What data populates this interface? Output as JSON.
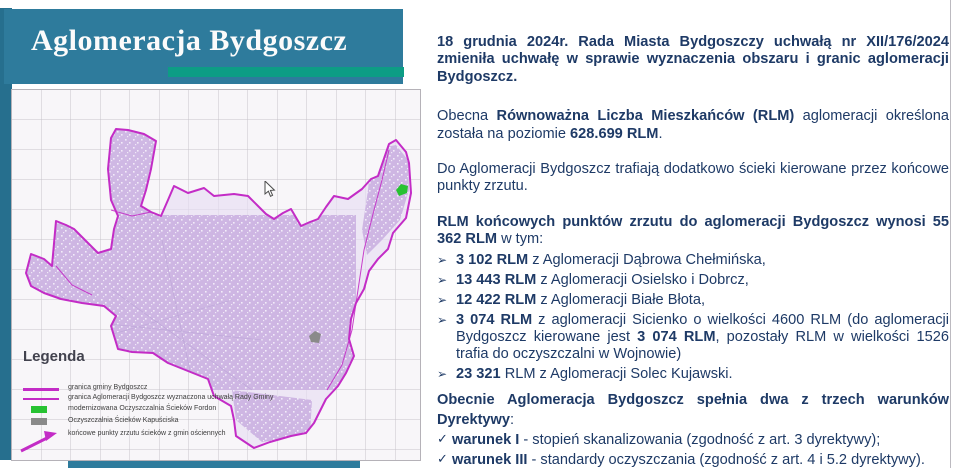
{
  "banner": {
    "title": "Aglomeracja Bydgoszcz"
  },
  "map": {
    "legend": {
      "title": "Legenda",
      "items": [
        {
          "label": "granica gminy Bydgoszcz"
        },
        {
          "label": "granica Aglomeracji Bydgoszcz wyznaczona uchwałą Rady Gminy"
        },
        {
          "label": "modernizowana Oczyszczalnia Ścieków Fordon"
        },
        {
          "label": "Oczyszczalnia Ścieków Kapuściska"
        },
        {
          "label": "końcowe punkty zrzutu ścieków z gmin ościennych"
        }
      ]
    }
  },
  "content": {
    "p1": {
      "segments": [
        {
          "t": "18 grudnia 2024r. Rada Miasta Bydgoszczy uchwałą nr XII/176/2024 zmieniła uchwałę w sprawie wyznaczenia obszaru i granic aglomeracji Bydgoszcz.",
          "b": true
        }
      ]
    },
    "p2": {
      "segments": [
        {
          "t": "Obecna ",
          "b": false
        },
        {
          "t": "Równoważna Liczba Mieszkańców (RLM)",
          "b": true
        },
        {
          "t": " aglomeracji określona została na poziomie ",
          "b": false
        },
        {
          "t": "628.699 RLM",
          "b": true
        },
        {
          "t": ".",
          "b": false
        }
      ]
    },
    "p3": {
      "segments": [
        {
          "t": "Do Aglomeracji Bydgoszcz trafiają dodatkowo ścieki kierowane przez końcowe punkty zrzutu.",
          "b": false
        }
      ]
    },
    "p4": {
      "segments": [
        {
          "t": "RLM końcowych punktów zrzutu do aglomeracji Bydgoszcz wynosi 55 362 RLM",
          "b": true
        },
        {
          "t": " w tym:",
          "b": false
        }
      ]
    },
    "bullets": {
      "items": [
        {
          "marker": "➢",
          "segments": [
            {
              "t": "3 102 RLM",
              "b": true
            },
            {
              "t": " z Aglomeracji Dąbrowa Chełmińska,",
              "b": false
            }
          ]
        },
        {
          "marker": "➢",
          "segments": [
            {
              "t": "13 443 RLM",
              "b": true
            },
            {
              "t": " z Aglomeracji Osielsko i Dobrcz,",
              "b": false
            }
          ]
        },
        {
          "marker": "➢",
          "segments": [
            {
              "t": "12 422 RLM",
              "b": true
            },
            {
              "t": " z Aglomeracji Białe Błota,",
              "b": false
            }
          ]
        },
        {
          "marker": "➢",
          "segments": [
            {
              "t": "3 074 RLM",
              "b": true
            },
            {
              "t": " z aglomeracji Sicienko o wielkości 4600 RLM (do aglomeracji Bydgoszcz kierowane jest ",
              "b": false
            },
            {
              "t": "3 074 RLM",
              "b": true
            },
            {
              "t": ", pozostały RLM w wielkości 1526 trafia do oczyszczalni w Wojnowie)",
              "b": false
            }
          ]
        },
        {
          "marker": "➢",
          "segments": [
            {
              "t": "23 321",
              "b": true
            },
            {
              "t": " RLM z Aglomeracji Solec Kujawski.",
              "b": false
            }
          ]
        }
      ]
    },
    "conditions": {
      "header": {
        "segments": [
          {
            "t": "Obecnie Aglomeracja Bydgoszcz spełnia dwa z trzech warunków Dyrektywy",
            "b": true
          },
          {
            "t": ":",
            "b": false
          }
        ]
      },
      "items": [
        {
          "marker": "✓",
          "segments": [
            {
              "t": "warunek I",
              "b": true
            },
            {
              "t": " - stopień skanalizowania (zgodność z art. 3 dyrektywy);",
              "b": false
            }
          ]
        },
        {
          "marker": "✓",
          "segments": [
            {
              "t": "warunek III",
              "b": true
            },
            {
              "t": " - standardy oczyszczania (zgodność z art. 4 i 5.2 dyrektywy).",
              "b": false
            }
          ]
        },
        {
          "marker": "➢",
          "segments": [
            {
              "t": "niespełniony ",
              "b": false
            },
            {
              "t": "warunek II - wydajność oczyszczalni",
              "b": true
            }
          ]
        }
      ]
    }
  },
  "colors": {
    "teal": "#2e7b9c",
    "teal-dark": "#266f8e",
    "green": "#0d9d85",
    "navy": "#1e3a66",
    "magenta": "#c32cc6",
    "lavender": "#ccb3e2",
    "marker-green": "#27c232",
    "marker-gray": "#8a8a8a"
  }
}
